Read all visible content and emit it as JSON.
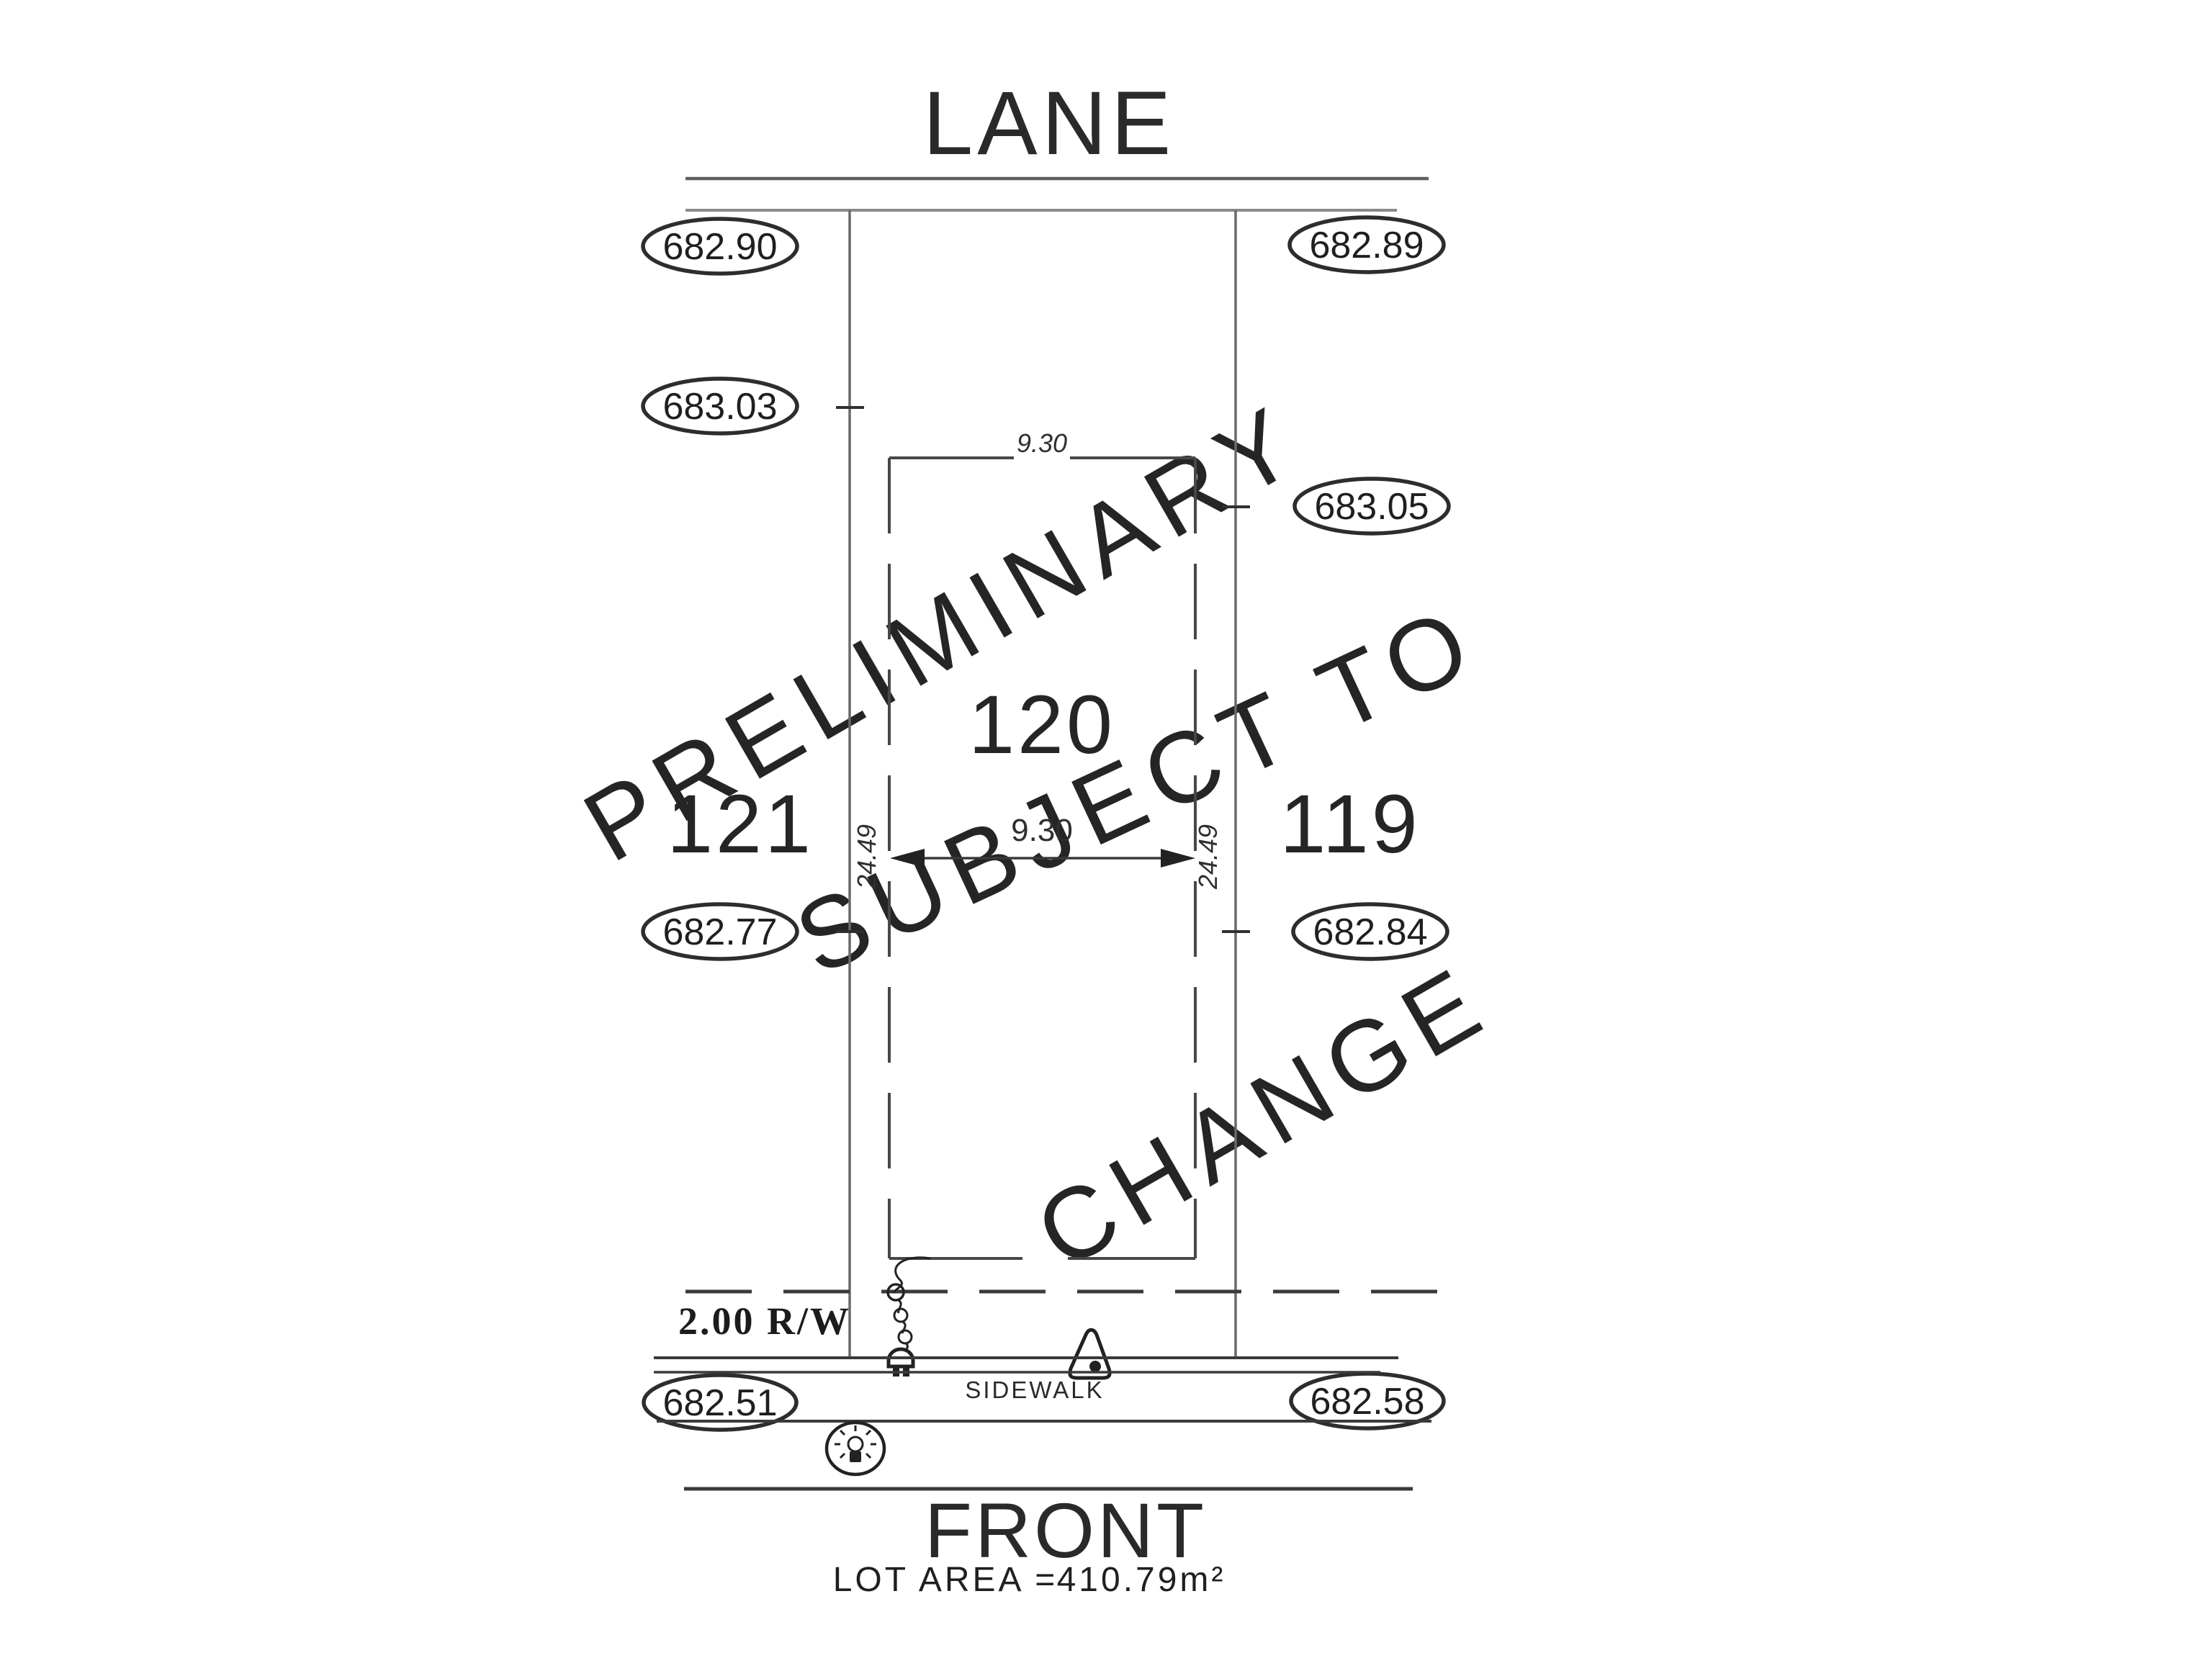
{
  "drawing": {
    "lane_label": "LANE",
    "front_label": "FRONT",
    "sidewalk_label": "SIDEWALK",
    "rw_label": "2.00 R/W",
    "lot_area_label": "LOT AREA =",
    "lot_area_value": "410.79m²",
    "lots": {
      "left": "121",
      "center": "120",
      "right": "119"
    },
    "elevations": {
      "lane_left": "682.90",
      "lane_right": "682.89",
      "upper_left": "683.03",
      "upper_right": "683.05",
      "mid_left": "682.77",
      "mid_right": "682.84",
      "sidewalk_left": "682.51",
      "sidewalk_right": "682.58"
    },
    "dimensions": {
      "top_width": "9.30",
      "mid_width": "9.30",
      "left_depth": "24.49",
      "right_depth": "24.49"
    },
    "watermark": {
      "line1": "PRELIMINARY",
      "line2": "SUBJECT TO",
      "line3": "CHANGE",
      "color": "#cacaca"
    },
    "colors": {
      "ink": "#252525",
      "line_gray": "#6a6a6a",
      "background": "#ffffff"
    }
  }
}
